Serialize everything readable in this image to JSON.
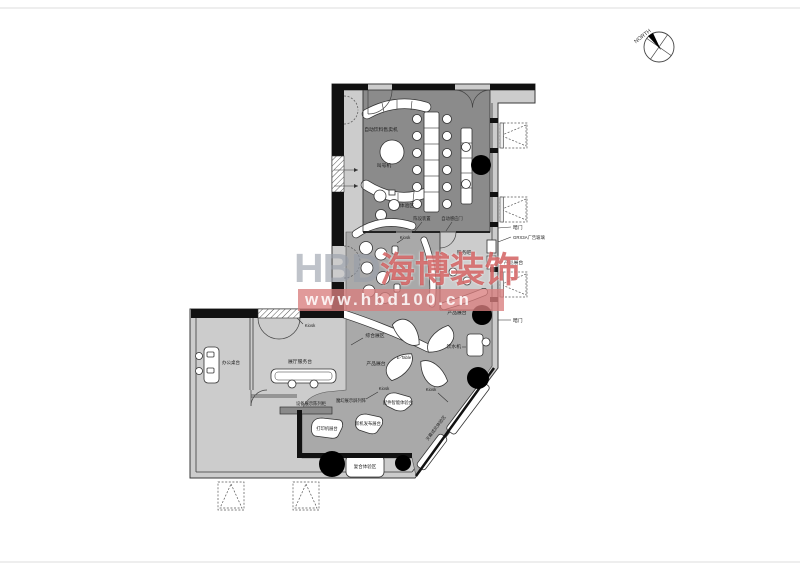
{
  "document": {
    "type": "interior floor plan drawing",
    "page_border_color": "#d9d9d9"
  },
  "compass": {
    "label": "NORTH"
  },
  "watermark": {
    "brand_latin": "HBD",
    "brand_cn": "海博装饰",
    "url": "www.hbd100.cn",
    "red": "#c63232",
    "band_red": "#d97d7d",
    "gray": "#989eaa"
  },
  "colors": {
    "floor_light": "#cccccc",
    "floor_medium": "#a9a9a9",
    "floor_dark": "#8b8b8b",
    "wall": "#111111",
    "furniture": "#ffffff",
    "column": "#000000"
  },
  "plan": {
    "labels": [
      {
        "text": "自动饮料售卖机",
        "x": 381,
        "y": 131
      },
      {
        "text": "叫号机",
        "x": 384,
        "y": 167
      },
      {
        "text": "体验区",
        "x": 407,
        "y": 207
      },
      {
        "text": "陈设装置",
        "x": 422,
        "y": 220,
        "size": 4.3
      },
      {
        "text": "自动感应门",
        "x": 452,
        "y": 220,
        "size": 4.3
      },
      {
        "text": "暗门",
        "x": 513,
        "y": 229,
        "anchor": "start"
      },
      {
        "text": "GRX3A广告玻璃",
        "x": 513,
        "y": 239,
        "anchor": "start",
        "size": 4.3
      },
      {
        "text": "产品展台",
        "x": 504,
        "y": 264,
        "anchor": "start"
      },
      {
        "text": "暗门",
        "x": 513,
        "y": 322,
        "anchor": "start"
      },
      {
        "text": "服务吧",
        "x": 464,
        "y": 254
      },
      {
        "text": "Kiosk",
        "x": 405,
        "y": 239,
        "size": 4.3
      },
      {
        "text": "综合展区",
        "x": 375,
        "y": 337
      },
      {
        "text": "E-Table",
        "x": 404,
        "y": 359,
        "size": 4.3
      },
      {
        "text": "产品展台",
        "x": 376,
        "y": 365
      },
      {
        "text": "产品展台",
        "x": 457,
        "y": 314
      },
      {
        "text": "饮水机",
        "x": 461,
        "y": 348,
        "anchor": "end"
      },
      {
        "text": "Kiosk",
        "x": 384,
        "y": 390,
        "size": 4.3
      },
      {
        "text": "Kiosk",
        "x": 431,
        "y": 391,
        "size": 4.3
      },
      {
        "text": "魔幻展示屏列阵",
        "x": 351,
        "y": 402,
        "size": 4.3
      },
      {
        "text": "设备展示陈列柜",
        "x": 311,
        "y": 405,
        "size": 4.3
      },
      {
        "text": "打印机展台",
        "x": 327,
        "y": 430,
        "size": 4.3
      },
      {
        "text": "新机发布展台",
        "x": 368,
        "y": 425,
        "size": 4.3
      },
      {
        "text": "配件智能体验台",
        "x": 398,
        "y": 404,
        "size": 4.3
      },
      {
        "text": "天幕成风体验区",
        "x": 437,
        "y": 429,
        "rot": -53,
        "size": 4.3
      },
      {
        "text": "复合体验区",
        "x": 365,
        "y": 468,
        "size": 4.5
      },
      {
        "text": "展厅服务台",
        "x": 300,
        "y": 363
      },
      {
        "text": "办公桌台",
        "x": 231,
        "y": 364,
        "size": 4.5
      },
      {
        "text": "Kiosk",
        "x": 310,
        "y": 327,
        "size": 4.3
      }
    ]
  }
}
